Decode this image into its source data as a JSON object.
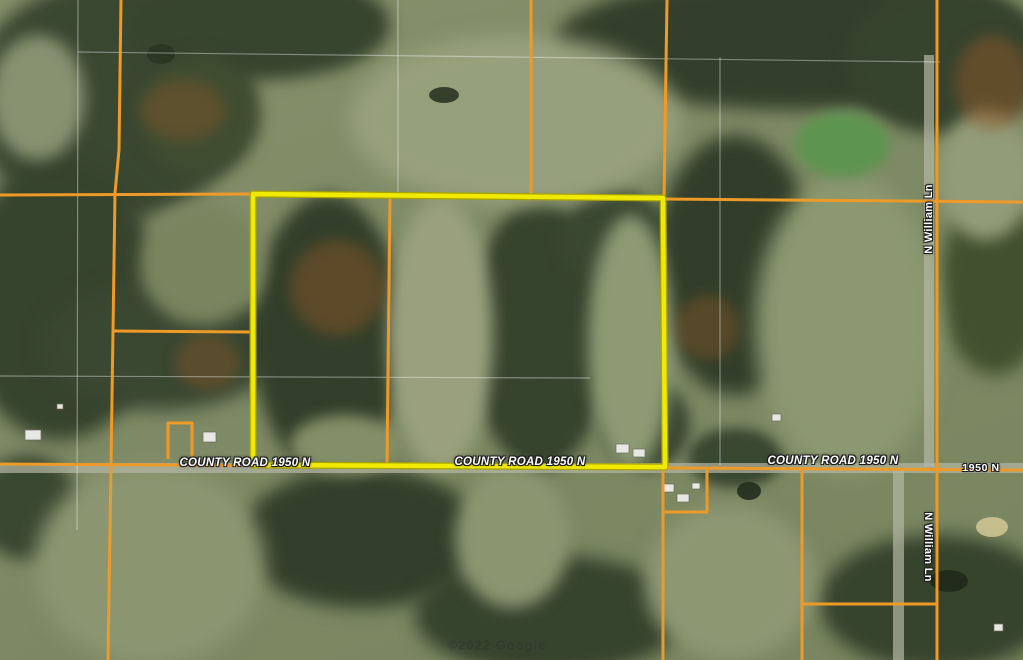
{
  "map": {
    "labels": [
      {
        "text": "COUNTY ROAD 1950 N",
        "cx": 245,
        "cy": 463,
        "rot": 0,
        "style": "road",
        "name": "road-label-county-road-1950n-west"
      },
      {
        "text": "COUNTY ROAD 1950 N",
        "cx": 520,
        "cy": 462,
        "rot": 0,
        "style": "road",
        "name": "road-label-county-road-1950n-center"
      },
      {
        "text": "COUNTY ROAD 1950 N",
        "cx": 833,
        "cy": 461,
        "rot": 0,
        "style": "road",
        "name": "road-label-county-road-1950n-east"
      },
      {
        "text": "1950 N",
        "cx": 981,
        "cy": 468,
        "rot": 0,
        "style": "road-small",
        "name": "road-label-1950n"
      },
      {
        "text": "N William Ln",
        "cx": 929,
        "cy": 219,
        "rot": -90,
        "style": "street",
        "name": "road-label-n-william-ln-north"
      },
      {
        "text": "N William Ln",
        "cx": 928,
        "cy": 547,
        "rot": 90,
        "style": "street",
        "name": "road-label-n-william-ln-south"
      }
    ],
    "watermark": {
      "text": "©2022 Google",
      "cx": 497,
      "cy": 645
    },
    "colors": {
      "parcel_line": "#ee9a28",
      "highlight_stroke": "#f0ea00",
      "highlight_edge": "#a9a300",
      "section_line": "rgba(255,255,255,0.38)",
      "road_surface": "#b5b7a5"
    },
    "highlight_parcel": {
      "points": [
        [
          253,
          194
        ],
        [
          663,
          198
        ],
        [
          665,
          467
        ],
        [
          253,
          465
        ]
      ],
      "closed": true
    },
    "parcel_lines": [
      {
        "name": "north-line-west",
        "points": [
          [
            0,
            195
          ],
          [
            253,
            194
          ]
        ]
      },
      {
        "name": "north-line-east",
        "points": [
          [
            663,
            199
          ],
          [
            1023,
            202
          ]
        ]
      },
      {
        "name": "west-parcel-line",
        "points": [
          [
            121,
            0
          ],
          [
            119,
            150
          ],
          [
            115,
            193
          ],
          [
            113,
            331
          ],
          [
            111,
            465
          ],
          [
            108,
            660
          ]
        ]
      },
      {
        "name": "west-parcel-spur",
        "points": [
          [
            114,
            331
          ],
          [
            250,
            332
          ]
        ]
      },
      {
        "name": "north-center-line",
        "points": [
          [
            531,
            0
          ],
          [
            531,
            196
          ]
        ]
      },
      {
        "name": "northeast-line",
        "points": [
          [
            667,
            0
          ],
          [
            664,
            198
          ]
        ]
      },
      {
        "name": "interior-line",
        "points": [
          [
            390,
            196
          ],
          [
            387,
            465
          ]
        ]
      },
      {
        "name": "william-ln-parcel-line",
        "points": [
          [
            937,
            0
          ],
          [
            937,
            660
          ]
        ]
      },
      {
        "name": "county-road-line",
        "points": [
          [
            0,
            464
          ],
          [
            1023,
            470
          ]
        ]
      },
      {
        "name": "small-parcel-west",
        "points": [
          [
            168,
            459
          ],
          [
            168,
            423
          ],
          [
            192,
            423
          ],
          [
            192,
            459
          ]
        ]
      },
      {
        "name": "south-parcel-line",
        "points": [
          [
            663,
            470
          ],
          [
            663,
            660
          ]
        ]
      },
      {
        "name": "south-parcel-spur",
        "points": [
          [
            707,
            470
          ],
          [
            707,
            512
          ],
          [
            663,
            512
          ]
        ]
      },
      {
        "name": "south-center-line",
        "points": [
          [
            802,
            470
          ],
          [
            802,
            660
          ]
        ]
      },
      {
        "name": "south-east-spur",
        "points": [
          [
            802,
            604
          ],
          [
            937,
            604
          ]
        ]
      }
    ],
    "section_lines": [
      {
        "name": "section-line-h-north",
        "points": [
          [
            78,
            52
          ],
          [
            940,
            62
          ]
        ]
      },
      {
        "name": "section-line-v-west",
        "points": [
          [
            78,
            0
          ],
          [
            77,
            530
          ]
        ]
      },
      {
        "name": "section-line-v-northcenter",
        "points": [
          [
            398,
            0
          ],
          [
            398,
            195
          ]
        ]
      },
      {
        "name": "section-line-v-east",
        "points": [
          [
            720,
            57
          ],
          [
            720,
            465
          ]
        ]
      },
      {
        "name": "section-line-h-center",
        "points": [
          [
            0,
            376
          ],
          [
            590,
            378
          ]
        ]
      }
    ],
    "roads_imagery": [
      {
        "name": "county-road-surface",
        "rect": [
          0,
          463,
          1023,
          10
        ]
      },
      {
        "name": "william-ln-surface-north",
        "rect": [
          924,
          55,
          10,
          412
        ]
      },
      {
        "name": "william-ln-surface-south",
        "rect": [
          893,
          470,
          11,
          190
        ]
      }
    ]
  }
}
